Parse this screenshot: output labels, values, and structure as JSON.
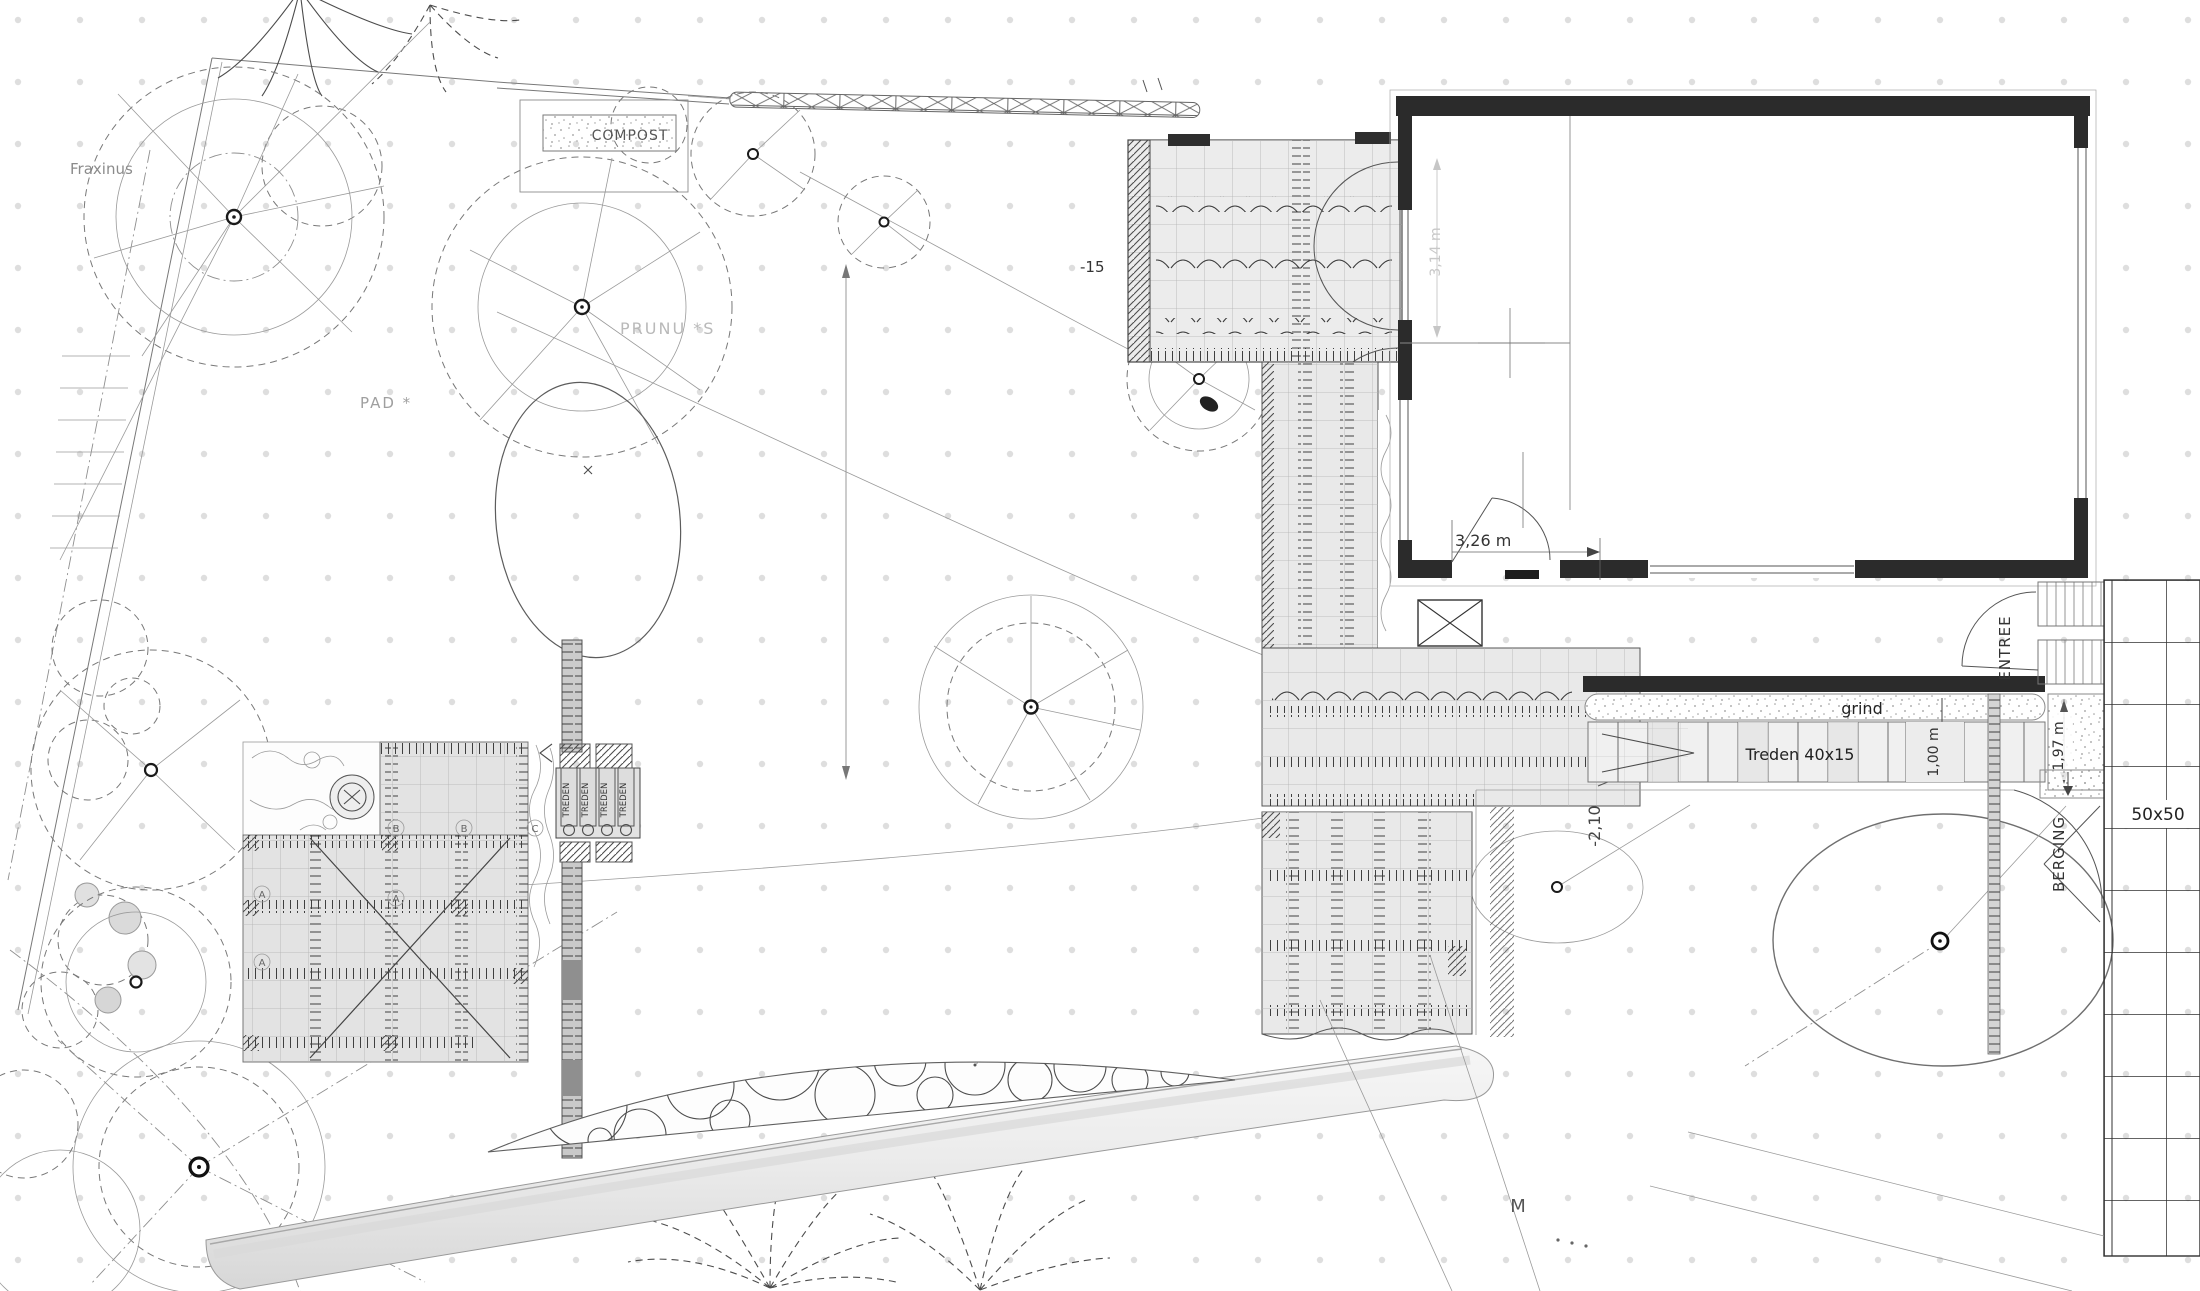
{
  "drawing_type": "garden-landscape-site-plan",
  "labels": {
    "compost": "COMPOST",
    "fraxinus": "Fraxinus",
    "prunus": "PRUNU *S",
    "pad": "PAD *",
    "level_pergola": "-15",
    "level_terrace": "-2,10",
    "entree": "ENTREE",
    "grind": "grind",
    "stairs": "Treden 40x15",
    "berging": "BERGING",
    "tile_size": "50x50",
    "m_mark": "M",
    "treden_step": "TREDEN"
  },
  "dimensions": {
    "door_width": "3,26 m",
    "window_width": "3,14 m",
    "stair_landing": "1,00 m",
    "entry_pad": "1,97 m"
  },
  "terrace_marks": [
    "B",
    "B",
    "C",
    "A",
    "A",
    "A"
  ]
}
